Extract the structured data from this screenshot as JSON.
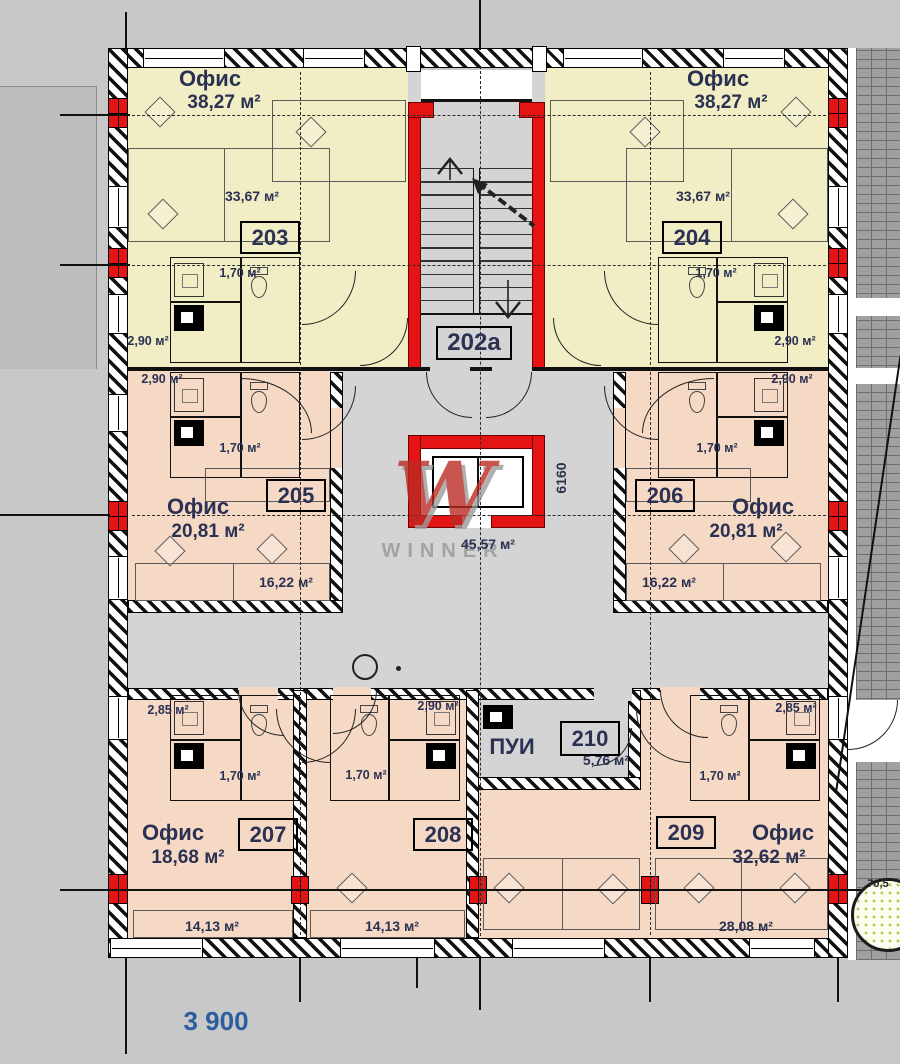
{
  "watermark": {
    "letter": "W",
    "text": "WINNER"
  },
  "hall": {
    "number": "202a",
    "area": "45,57 м²"
  },
  "service_room": {
    "number": "210",
    "name": "ПУИ",
    "area": "5,76 м²"
  },
  "rooms": {
    "r203": {
      "number": "203",
      "type": "Офис",
      "total": "38,27 м²",
      "main": "33,67 м²",
      "wc": "1,70 м²",
      "bath": "2,90 м²"
    },
    "r204": {
      "number": "204",
      "type": "Офис",
      "total": "38,27 м²",
      "main": "33,67 м²",
      "wc": "1,70 м²",
      "bath": "2,90 м²"
    },
    "r205": {
      "number": "205",
      "type": "Офис",
      "total": "20,81 м²",
      "main": "16,22 м²",
      "wc": "1,70 м²",
      "bath": "2,90 м²"
    },
    "r206": {
      "number": "206",
      "type": "Офис",
      "total": "20,81 м²",
      "main": "16,22 м²",
      "wc": "1,70 м²",
      "bath": "2,90 м²"
    },
    "r207": {
      "number": "207",
      "type": "Офис",
      "total": "18,68 м²",
      "main": "14,13 м²",
      "wc": "1,70 м²",
      "bath": "2,85 м²"
    },
    "r208": {
      "number": "208",
      "main": "14,13 м²",
      "wc": "1,70 м²",
      "bath": "2,90 м²"
    },
    "r209": {
      "number": "209",
      "type": "Офис",
      "total": "32,62 м²",
      "main": "28,08 м²",
      "wc": "1,70 м²",
      "bath": "2,85 м²"
    }
  },
  "dimensions": {
    "bottom": "3 900",
    "shaft_height": "6160",
    "right_partial": "70,5"
  },
  "colors": {
    "office_yellow": "#f1edc4",
    "office_pink": "#f6d9c4",
    "hall_gray": "#d4d4d4",
    "accent_red": "#e41414",
    "text_navy": "#2a3153",
    "dim_blue": "#2b5e9e"
  }
}
